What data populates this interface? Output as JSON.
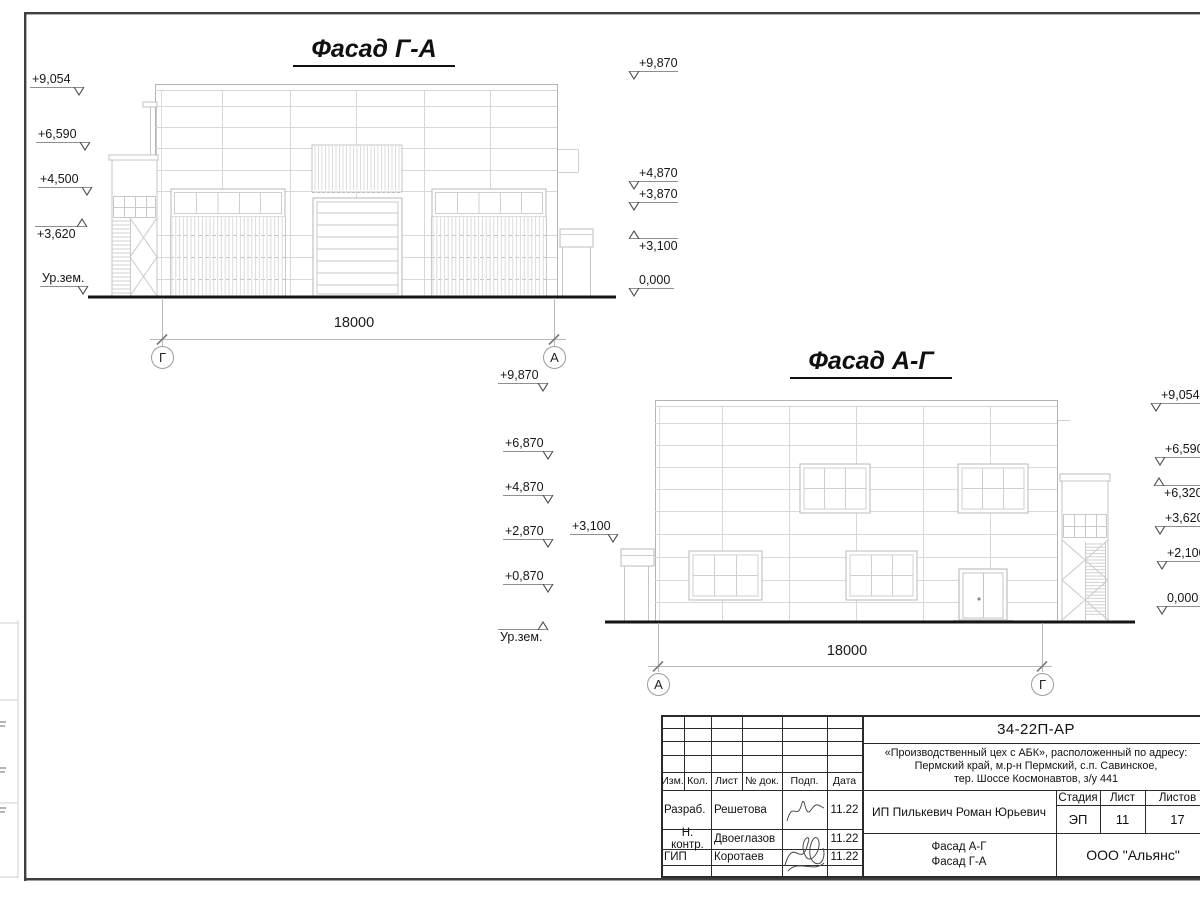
{
  "drawing": {
    "facade1": {
      "title": "Фасад Г-А",
      "dim": "18000",
      "axes": [
        "Г",
        "А"
      ],
      "marks_left": [
        "+9,054",
        "+6,590",
        "+4,500",
        "+3,620",
        "Ур.зем."
      ],
      "marks_right": [
        "+9,870",
        "+4,870",
        "+3,870",
        "+3,100",
        "0,000"
      ]
    },
    "facade2": {
      "title": "Фасад А-Г",
      "dim": "18000",
      "axes": [
        "А",
        "Г"
      ],
      "marks_left": [
        "+9,870",
        "+6,870",
        "+4,870",
        "+2,870",
        "+0,870",
        "Ур.зем.",
        "+3,100"
      ],
      "marks_right": [
        "+9,054",
        "+6,590",
        "+6,320",
        "+3,620",
        "+2,100",
        "0,000"
      ]
    }
  },
  "titleblock": {
    "doc_code": "34-22П-АР",
    "project_line1": "«Производственный цех с АБК», расположенный по адресу:",
    "project_line2": "Пермский край, м.р-н Пермский, с.п. Савинское,",
    "project_line3": "тер. Шоссе Космонавтов, з/у 441",
    "cols": {
      "izm": "Изм.",
      "kol": "Кол.",
      "list": "Лист",
      "doc": "№ док.",
      "podp": "Подп.",
      "data": "Дата"
    },
    "rows": [
      {
        "role": "Разраб.",
        "name": "Решетова",
        "date": "11.22"
      },
      {
        "role": "Н. контр.",
        "name": "Двоеглазов",
        "date": "11.22"
      },
      {
        "role": "ГИП",
        "name": "Коротаев",
        "date": "11.22"
      }
    ],
    "client": "ИП Пилькевич Роман Юрьевич",
    "stage_label": "Стадия",
    "sheet_label": "Лист",
    "sheets_label": "Листов",
    "stage": "ЭП",
    "sheet": "11",
    "sheets": "17",
    "title_line1": "Фасад А-Г",
    "title_line2": "Фасад Г-А",
    "company": "ООО \"Альянс\""
  }
}
